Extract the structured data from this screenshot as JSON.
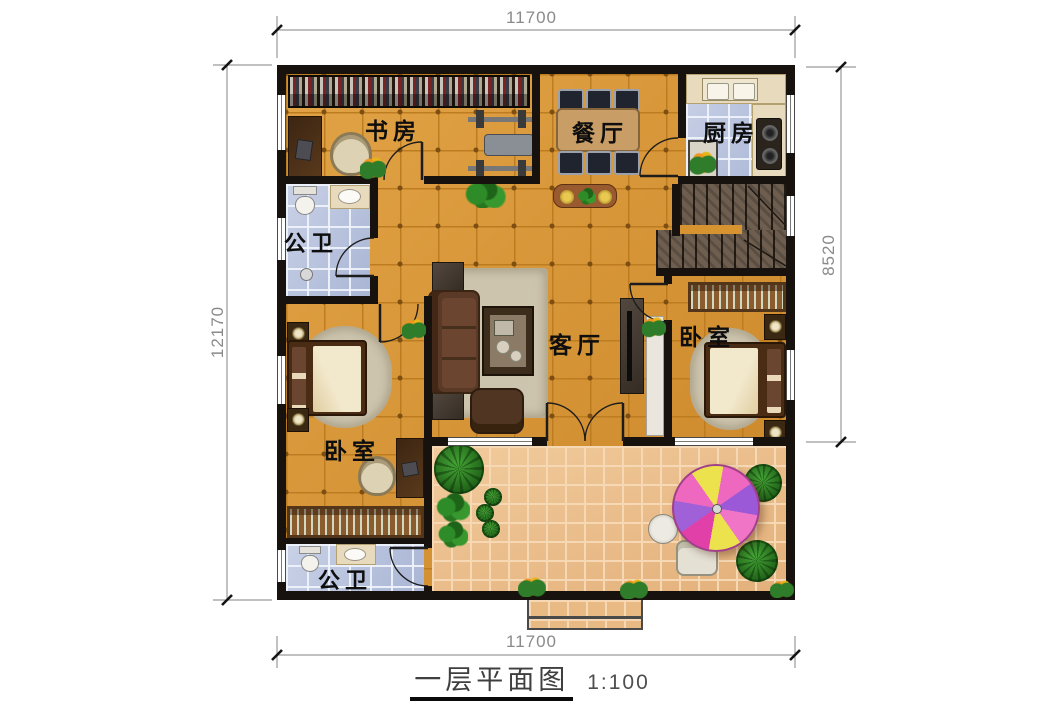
{
  "title_block": {
    "title": "一层平面图",
    "scale": "1:100"
  },
  "dimensions": {
    "top": "11700",
    "bottom": "11700",
    "left": "12170",
    "right": "8520"
  },
  "rooms": {
    "study": {
      "label": "书房"
    },
    "dining": {
      "label": "餐厅"
    },
    "kitchen": {
      "label": "厨房"
    },
    "bath_upper": {
      "label": "公卫"
    },
    "living": {
      "label": "客厅"
    },
    "bedroom_left": {
      "label": "卧室"
    },
    "bedroom_right": {
      "label": "卧室"
    },
    "bath_lower": {
      "label": "公卫"
    }
  },
  "colors": {
    "wall": "#17120d",
    "floor_main": "#d6932f",
    "floor_bath_kitchen": "#b7c2de",
    "floor_patio": "#eaba85",
    "stairs": "#6e5e50",
    "dimension_line": "#999999",
    "dimension_text": "#8a8a8a",
    "room_label_text": "#0e0e0e",
    "umbrella_segments": [
      "#ee68c0",
      "#9b59d8",
      "#ece24e",
      "#e040a8"
    ]
  }
}
